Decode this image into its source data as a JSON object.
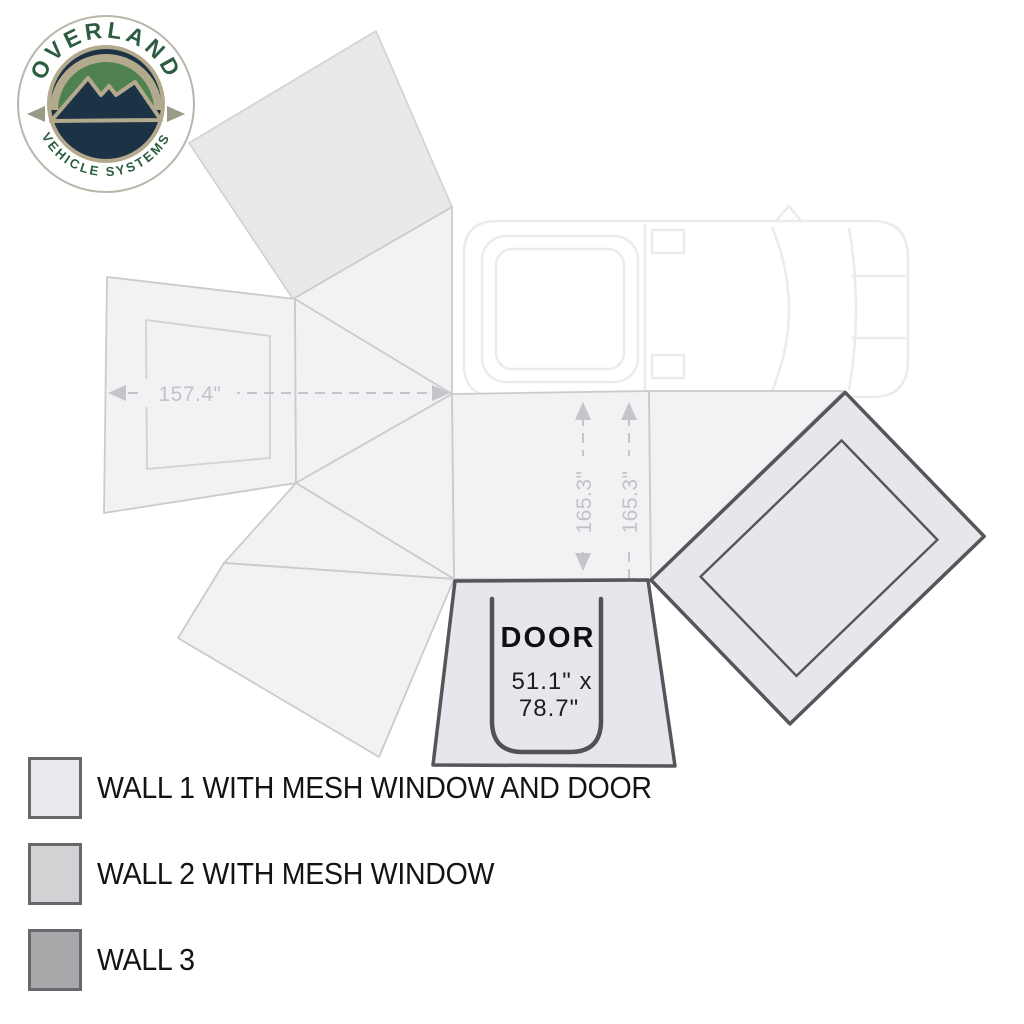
{
  "logo": {
    "brand_top": "OVERLAND",
    "brand_bottom": "VEHICLE SYSTEMS"
  },
  "dimensions": {
    "wall_width": "157.4\"",
    "wall_height_left": "165.3\"",
    "wall_height_right": "165.3\""
  },
  "door": {
    "label": "DOOR",
    "size_line1": "51.1\" x",
    "size_line2": "78.7\""
  },
  "legend": {
    "items": [
      {
        "label": "WALL 1 WITH MESH WINDOW AND DOOR",
        "swatch_color": "#e9e9ee"
      },
      {
        "label": "WALL 2 WITH MESH WINDOW",
        "swatch_color": "#d2d2d4"
      },
      {
        "label": "WALL 3",
        "swatch_color": "#a8a8aa"
      }
    ]
  },
  "colors": {
    "panel_light": "#f2f2f4",
    "panel_shaded": "#e9e9ea",
    "wall_panel_fill": "#e6e6ec",
    "panel_outline_dark": "#55555a",
    "dimension_gray": "#c5c5c9",
    "logo_green": "#4f8152",
    "logo_navy": "#1c3346",
    "logo_tan": "#b3aa8e",
    "logo_text_green": "#2d5c40"
  }
}
